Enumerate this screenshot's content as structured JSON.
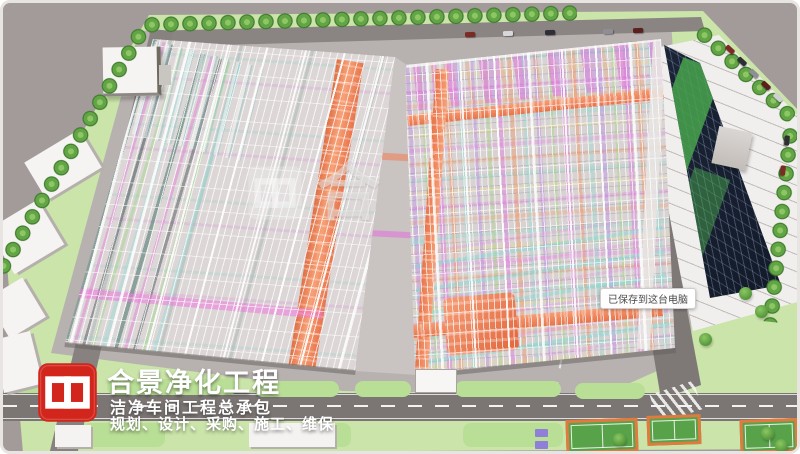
{
  "watermark": {
    "logo_icon": "hejing-logo-icon",
    "text": "合"
  },
  "save_tooltip": {
    "text": "已保存到这台电脑"
  },
  "brand": {
    "logo_icon": "hejing-logo-icon",
    "company": "合景净化工程",
    "tagline": "洁净车间工程总承包",
    "services": "规划、设计、采购、施工、维保"
  },
  "colors": {
    "background": "#a39a9a",
    "lawn": "#cae4a9",
    "logo_red": "#d2261c",
    "pipe_magenta": "#e06ee0",
    "pipe_violet": "#b487e0",
    "pipe_orange": "#f0825a",
    "pipe_cyan": "#8fd8d8",
    "pipe_green": "#9ad478",
    "pipe_yellow": "#e8d684",
    "glass_building": "#1d2a40",
    "court_green": "#58a34a",
    "court_border": "#e2793f"
  }
}
